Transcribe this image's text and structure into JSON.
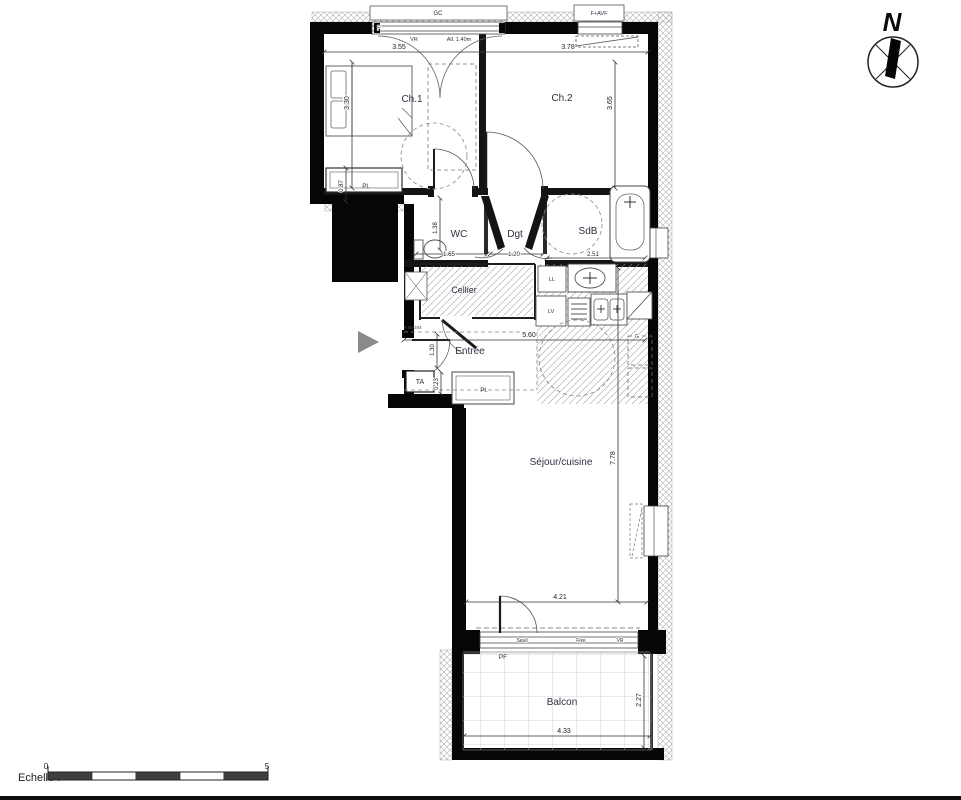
{
  "compass": {
    "north": "N"
  },
  "rooms": {
    "ch1": "Ch.1",
    "ch2": "Ch.2",
    "wc": "WC",
    "dgt": "Dgt",
    "sdb": "SdB",
    "cellier": "Cellier",
    "entree": "Entrée",
    "sejour": "Séjour/cuisine",
    "balcon": "Balcon"
  },
  "labels": {
    "pl_ch1": "Pl.",
    "pl_entree": "Pl.",
    "ta": "TA",
    "gc": "GC",
    "f_window": "F",
    "vr_window": "VR",
    "allege": "All. 1.40m",
    "f_avf": "F+AVF",
    "ll": "LL",
    "lv": "LV",
    "g": "G",
    "seuil": "Seuil",
    "fixe": "Fixe",
    "vr_bay": "VR",
    "pf": "PF",
    "door_ref": "P 80/204"
  },
  "dimensions": {
    "ch1_w": "3.55",
    "ch2_w": "3.78",
    "ch1_h": "3.30",
    "ch2_h": "3.65",
    "pl_d": "0.87",
    "wc_h": "1.38",
    "wc_w": "1.65",
    "dgt_w": "1.20",
    "sdb_w": "2.51",
    "entree_w": "5.60",
    "entree_h": "1.30",
    "ta_h": "0.23",
    "sejour_h": "7.78",
    "sejour_w": "4.21",
    "balcon_w": "4.33",
    "balcon_h": "2.27"
  },
  "scale": {
    "label": "Echelle :",
    "min": "0",
    "max": "5"
  },
  "colors": {
    "wall": "#060606",
    "dim_line": "#333333",
    "label_text": "#2b3240",
    "arrow_gray": "#8a8a8a"
  }
}
